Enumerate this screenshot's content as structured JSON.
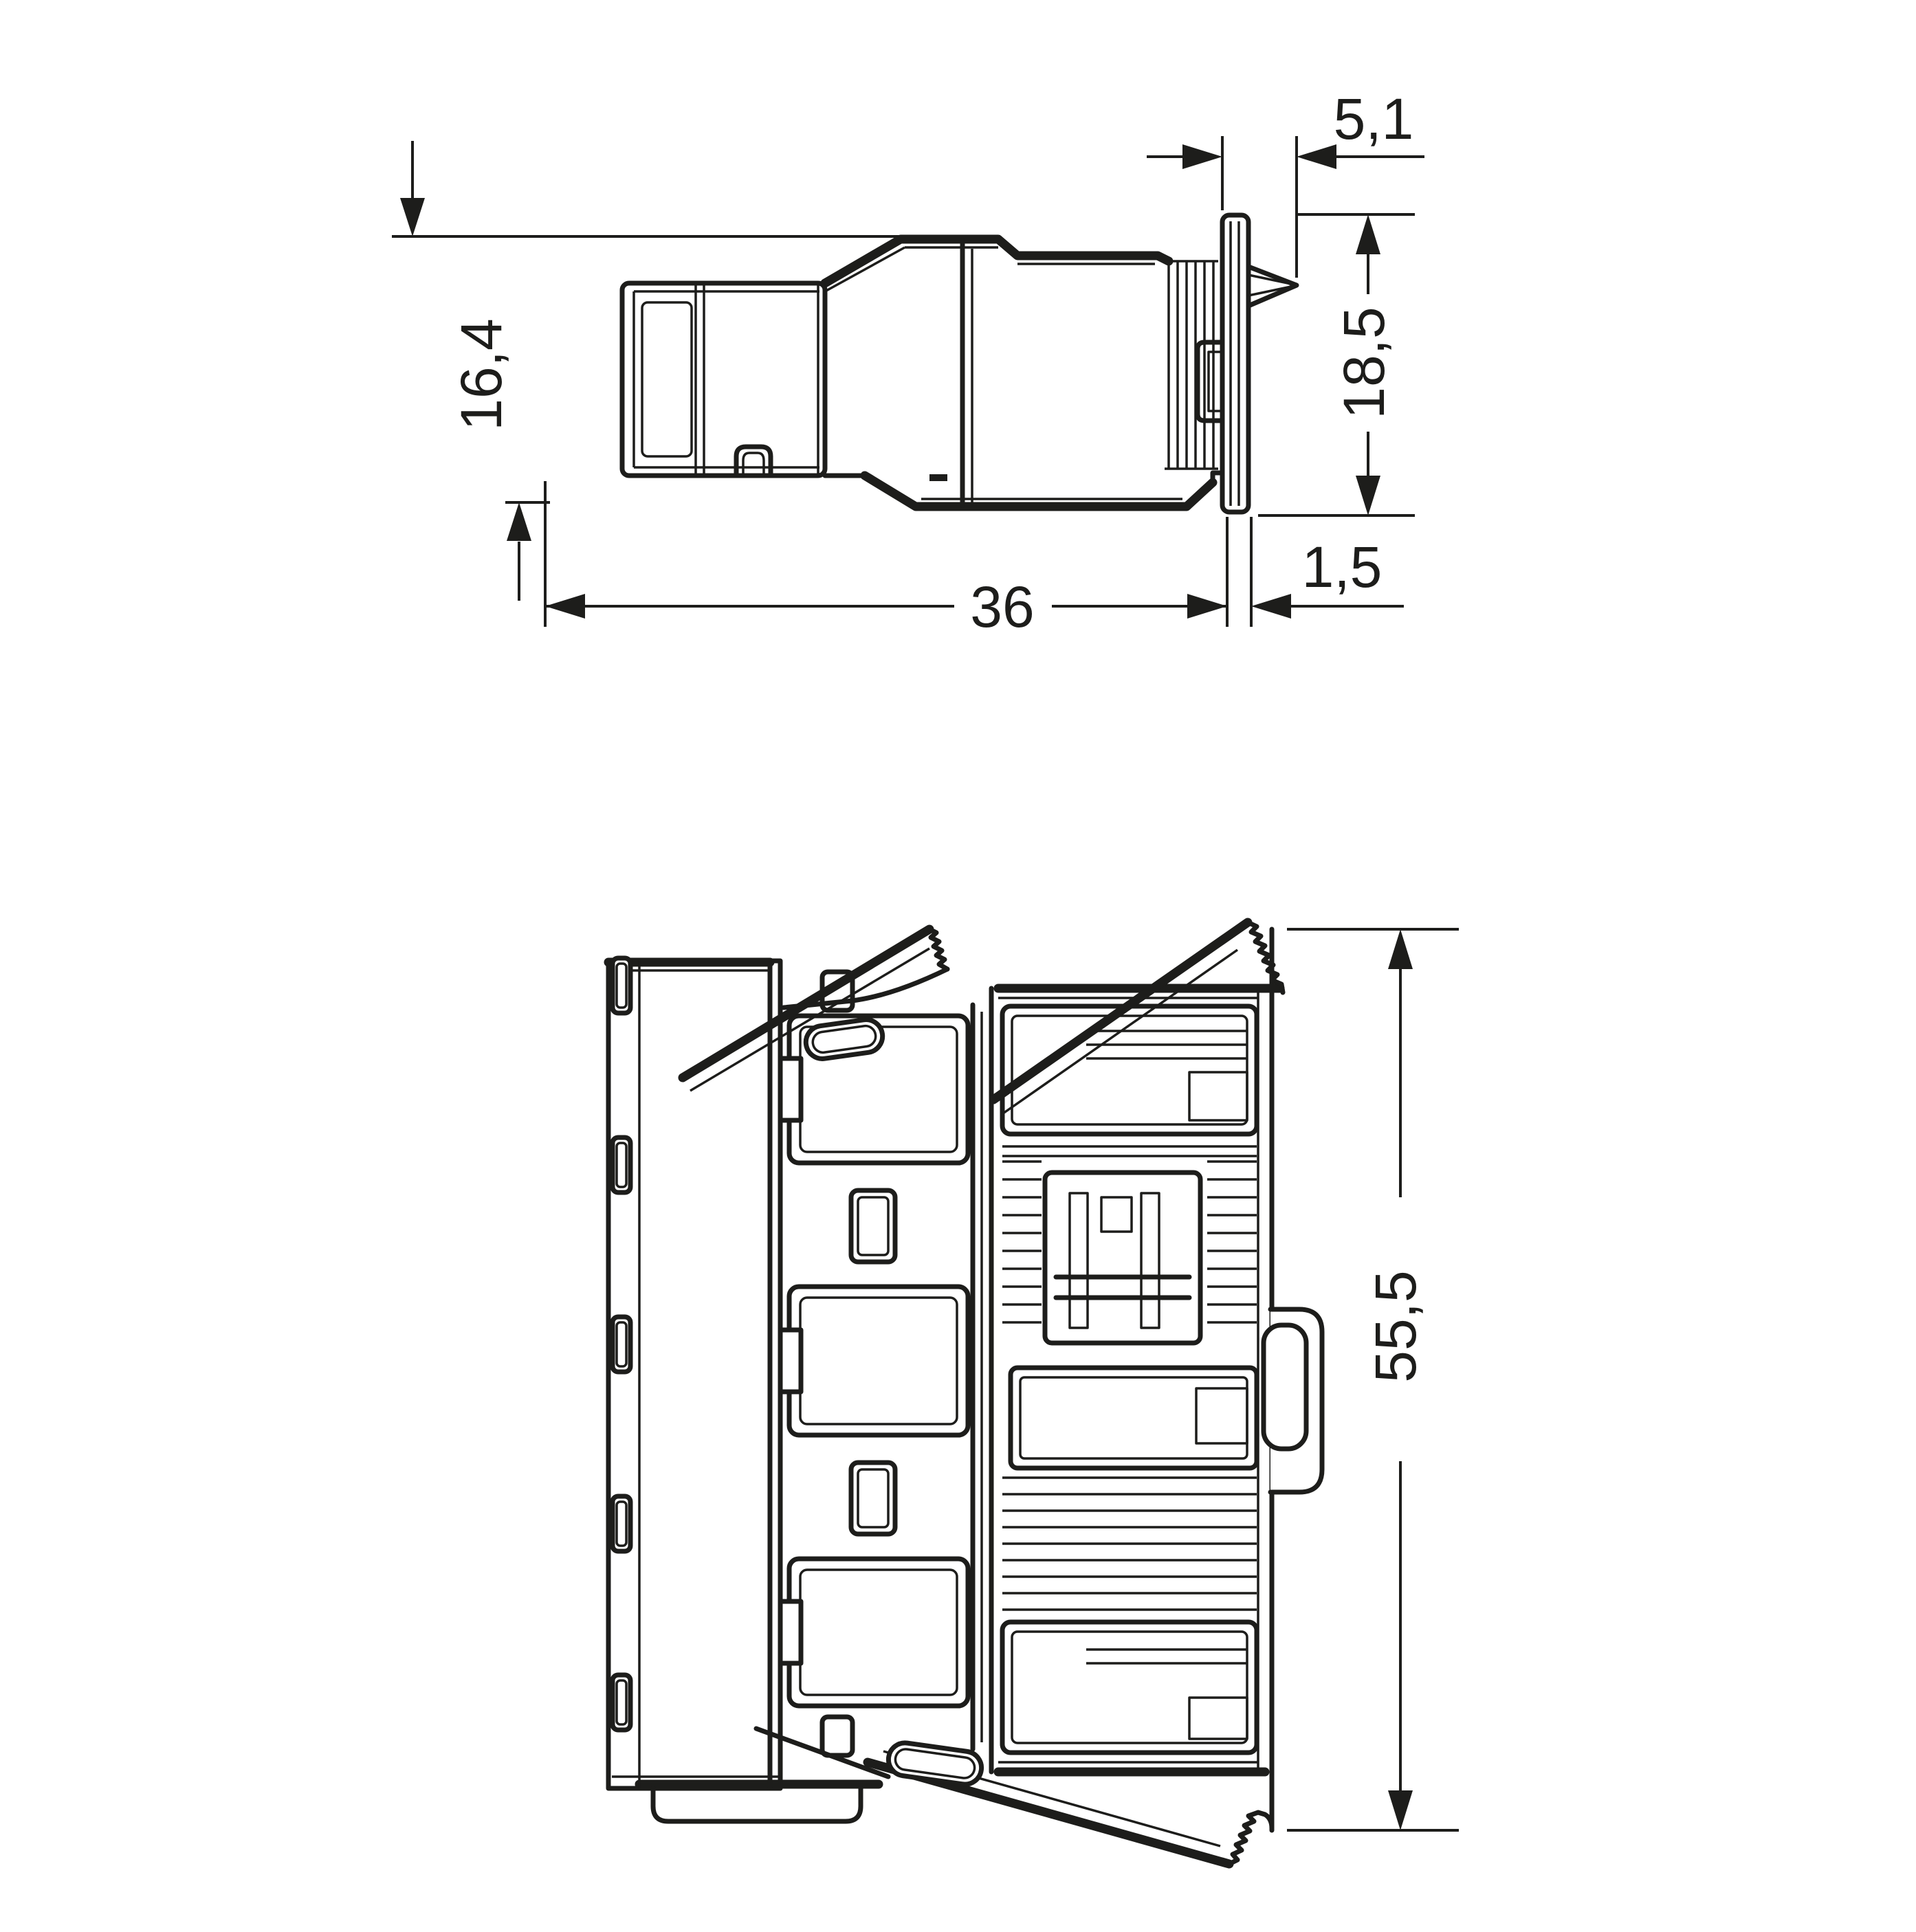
{
  "drawing": {
    "type": "technical-dimension-drawing",
    "colors": {
      "ink": "#1d1d1b",
      "background": "#ffffff"
    },
    "views": {
      "side_view": {
        "dimensions": {
          "front_height": {
            "value": "16,4",
            "orientation": "vertical"
          },
          "panel_clamp": {
            "value": "5,1",
            "orientation": "horizontal"
          },
          "flange_height": {
            "value": "18,5",
            "orientation": "vertical"
          },
          "body_length": {
            "value": "36",
            "orientation": "horizontal"
          },
          "flange_thickness": {
            "value": "1,5",
            "orientation": "horizontal"
          }
        }
      },
      "front_view": {
        "dimensions": {
          "overall_height": {
            "value": "55,5",
            "orientation": "vertical"
          }
        }
      }
    }
  }
}
